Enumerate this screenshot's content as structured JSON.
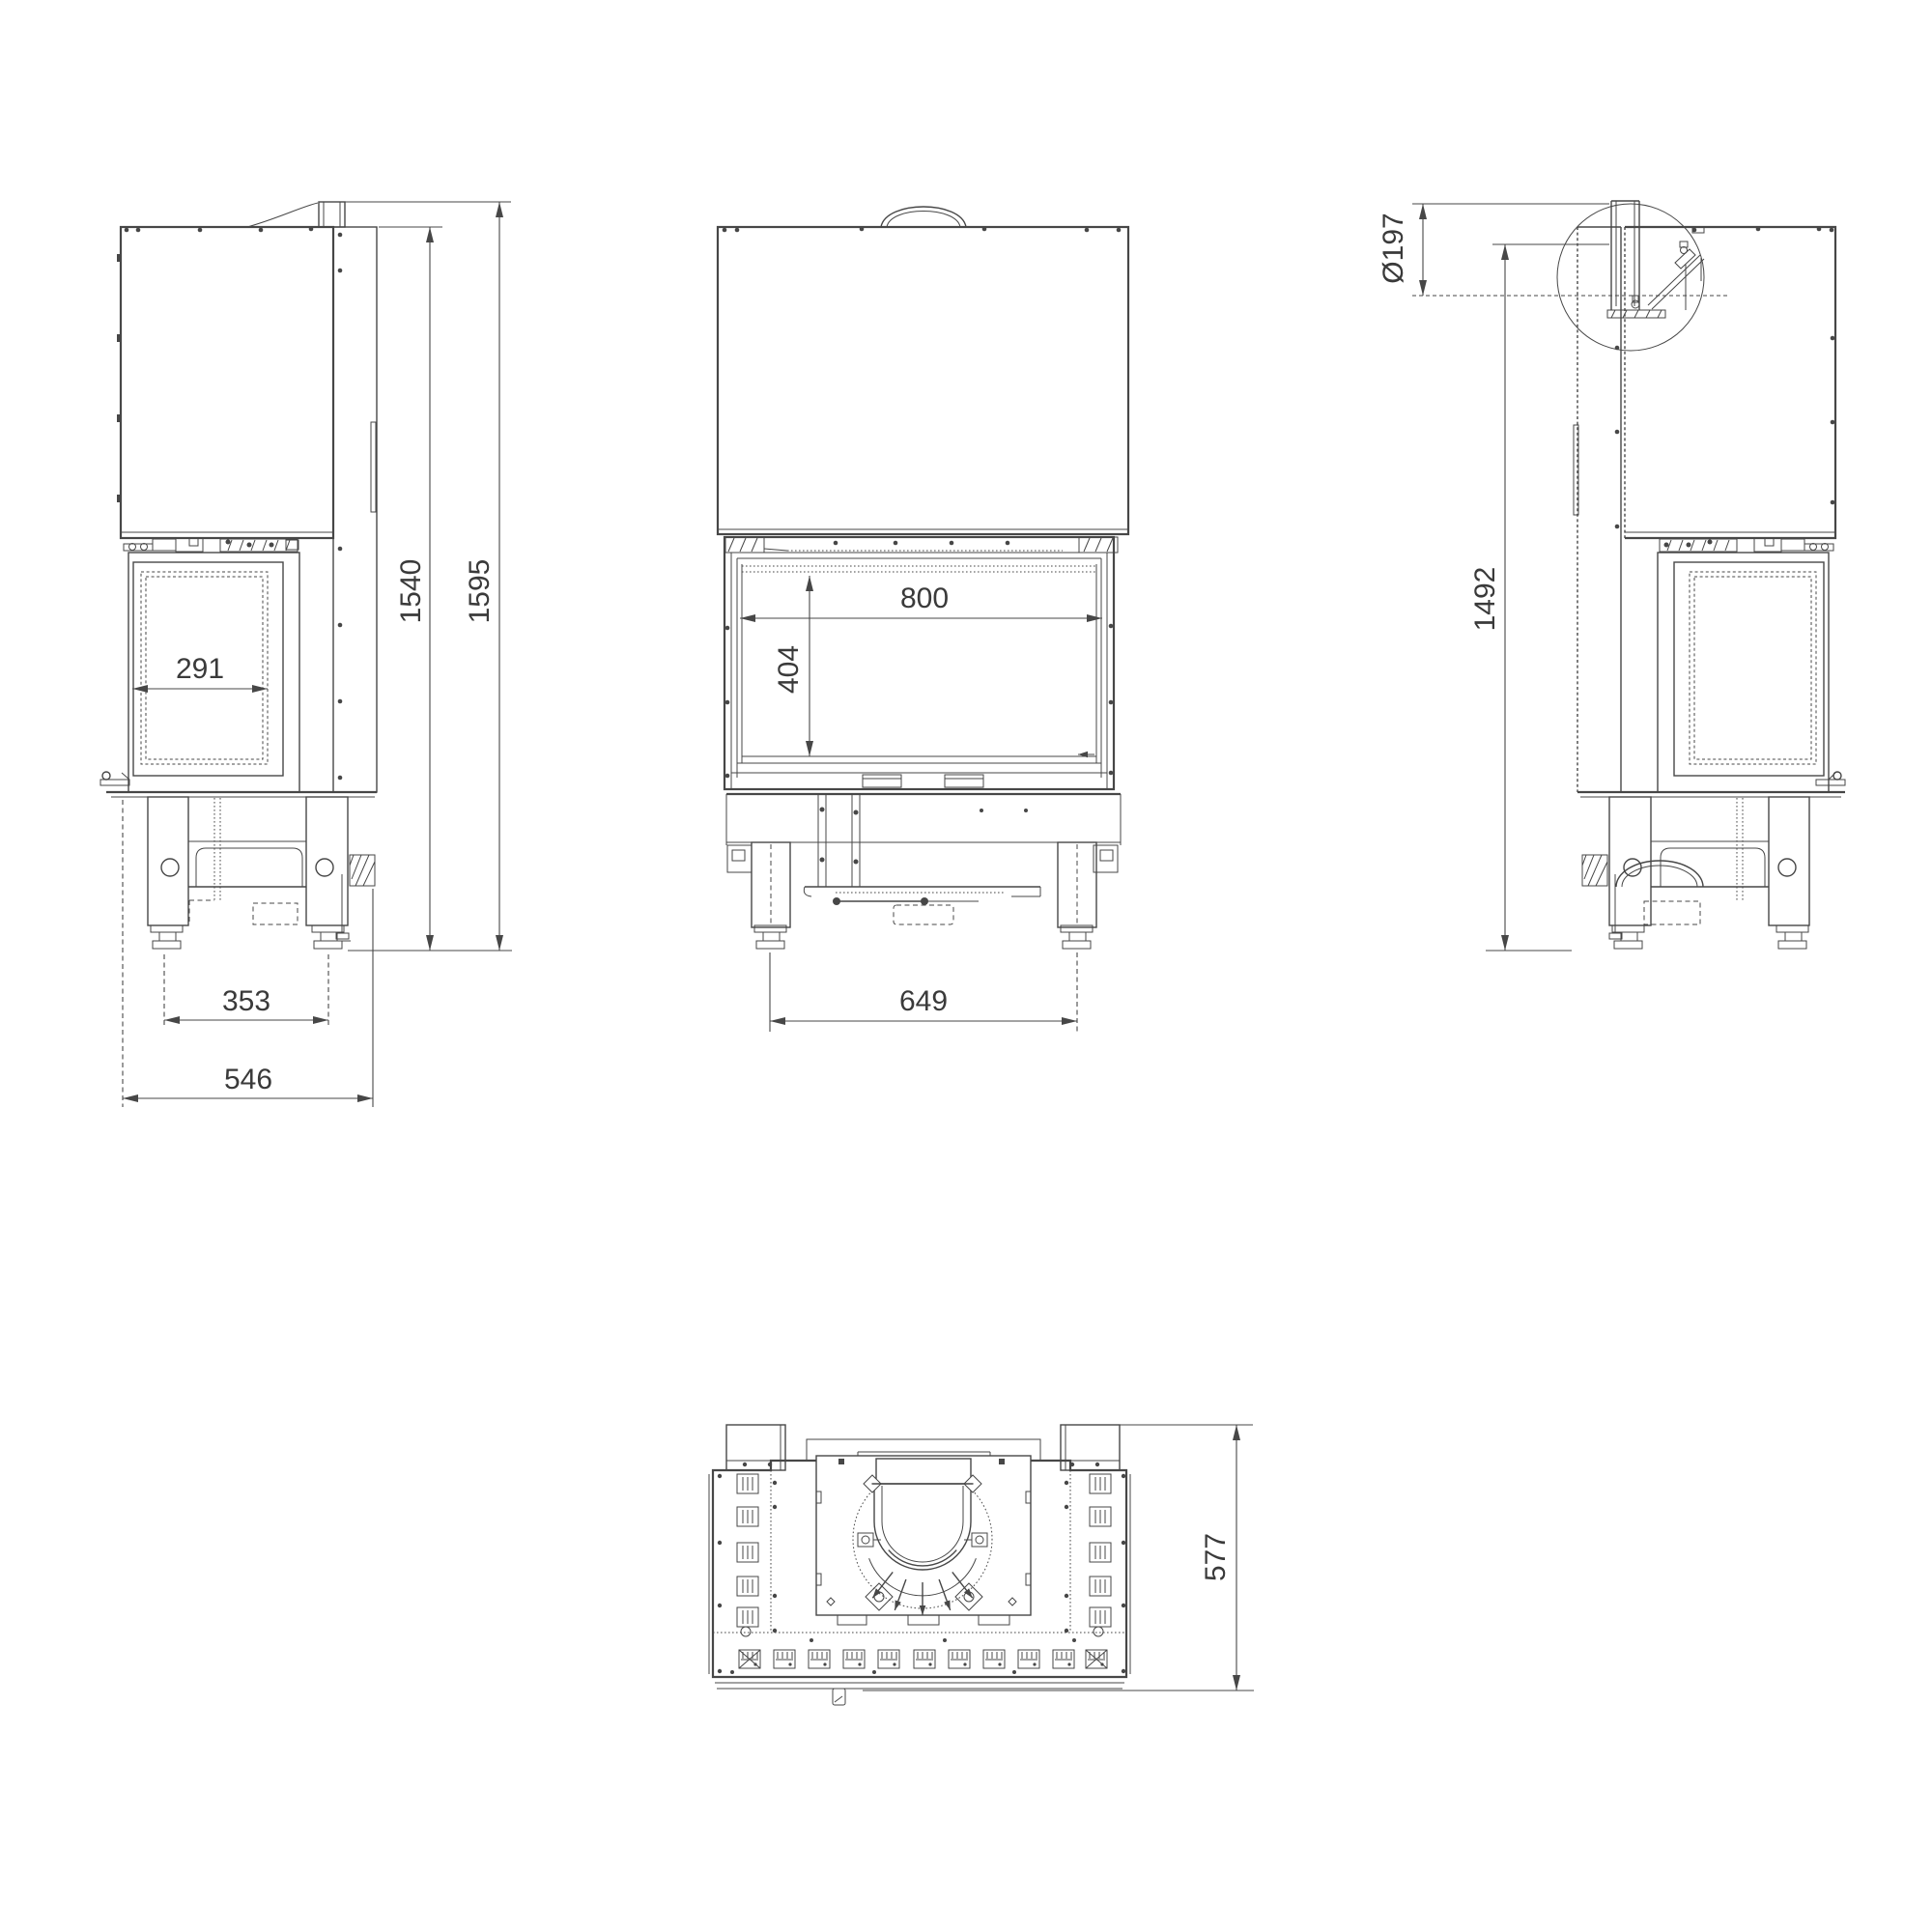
{
  "document": {
    "type": "technical-dimension-drawing",
    "subject": "fireplace-insert-four-views",
    "colors": {
      "line": "#474747",
      "text": "#3a3a3a",
      "background": "#ffffff"
    }
  },
  "views": {
    "side_left": {
      "dims": {
        "glass_depth": "291",
        "height_to_hood_top": "1540",
        "height_total": "1595",
        "feet_spacing": "353",
        "depth_total": "546"
      }
    },
    "front": {
      "dims": {
        "firebox_width": "800",
        "firebox_height": "404",
        "feet_spacing": "649"
      }
    },
    "side_right": {
      "dims": {
        "flue_diameter": "Ø197",
        "height_to_flue_outlet": "1492"
      }
    },
    "top": {
      "dims": {
        "depth": "577"
      }
    }
  }
}
